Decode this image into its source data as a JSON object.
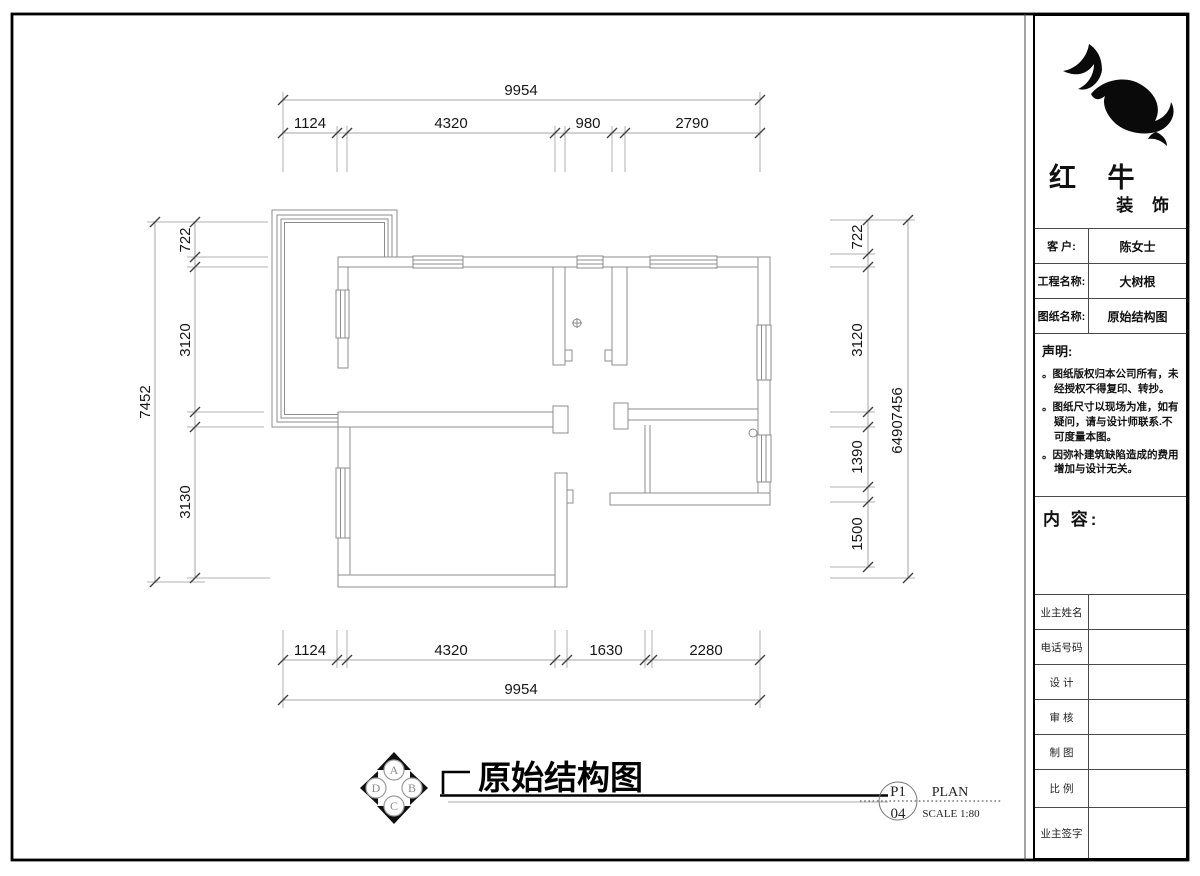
{
  "colors": {
    "wall_line": "#8c8c8c",
    "dimension_line": "#a6a6a6",
    "text": "#161616",
    "frame": "#000000"
  },
  "dims": {
    "top": {
      "overall": "9954",
      "segments": [
        "1124",
        "4320",
        "980",
        "2790"
      ]
    },
    "bottom": {
      "overall": "9954",
      "segments": [
        "1124",
        "4320",
        "1630",
        "2280"
      ]
    },
    "left": {
      "overall": "7452",
      "segments": [
        "722",
        "3120",
        "3130"
      ]
    },
    "right": {
      "overall_front": "7456",
      "overall_back": "6490",
      "segments": [
        "722",
        "3120",
        "1390",
        "1500"
      ]
    }
  },
  "plan_title": {
    "text": "原始结构图"
  },
  "compass": {
    "top": "A",
    "right": "B",
    "bottom": "C",
    "left": "D"
  },
  "page_marker": {
    "sheet_no": "P1",
    "page_no": "04",
    "name": "PLAN",
    "scale": "SCALE 1:80"
  },
  "title_block": {
    "brand": {
      "name": "红 牛",
      "suffix": "装 饰",
      "logo_icon": "bull-swoosh"
    },
    "info": [
      {
        "label": "客  户:",
        "value": "陈女士"
      },
      {
        "label": "工程名称:",
        "value": "大树根"
      },
      {
        "label": "图纸名称:",
        "value": "原始结构图"
      }
    ],
    "statement": {
      "title": "声明:",
      "items": [
        "。图纸版权归本公司所有，未经授权不得复印、转抄。",
        "。图纸尺寸以现场为准，如有疑问，请与设计师联系.不可度量本图。",
        "。因弥补建筑缺陷造成的费用增加与设计无关。"
      ]
    },
    "content_label": "内 容:",
    "form_rows": [
      "业主姓名",
      "电话号码",
      "设 计",
      "审 核",
      "制 图",
      "比 例",
      "业主签字"
    ]
  }
}
